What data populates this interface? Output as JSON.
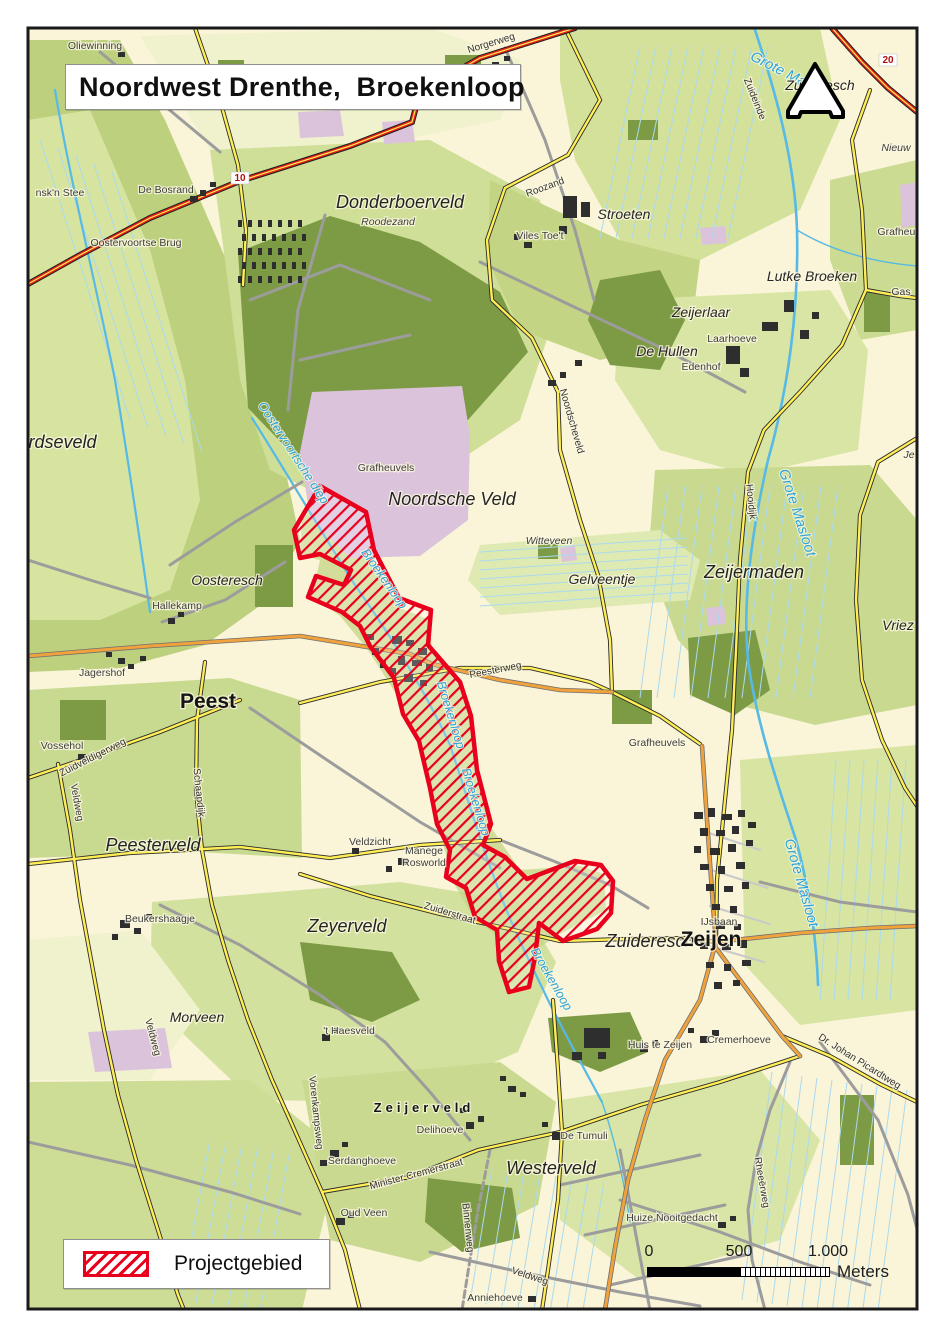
{
  "title": "Noordwest Drenthe,  Broekenloop",
  "legend": {
    "label": "Projectgebied",
    "swatch_icon": "red-hatch-swatch"
  },
  "scalebar": {
    "ticks": [
      "0",
      "500",
      "1.000"
    ],
    "units": "Meters"
  },
  "icons": {
    "north_arrow": "north-arrow"
  },
  "colors": {
    "project_red": "#e8001c",
    "water_blue": "#56b9e6",
    "forest_green": "#7d9b45",
    "field_green": "#cfdf97",
    "heath_pink": "#dcc3dc",
    "road_yellow": "#ffee55",
    "road_orange": "#f0a23c",
    "road_red": "#e32119",
    "paper_cream": "#faf4d8"
  },
  "map": {
    "labels": [
      {
        "t": "Oliewinning",
        "x": 95,
        "y": 49,
        "c": "farm"
      },
      {
        "t": "Norgerweg",
        "x": 492,
        "y": 46,
        "c": "road",
        "r": -17
      },
      {
        "t": "nsk'n Stee",
        "x": 60,
        "y": 196,
        "c": "farm"
      },
      {
        "t": "De Bosrand",
        "x": 166,
        "y": 193,
        "c": "farm"
      },
      {
        "t": "10",
        "x": 240,
        "y": 181,
        "c": "roadnum"
      },
      {
        "t": "20",
        "x": 888,
        "y": 63,
        "c": "roadnum"
      },
      {
        "t": "Oostervoortse Brug",
        "x": 136,
        "y": 246,
        "c": "farm"
      },
      {
        "t": "Donderboerveld",
        "x": 400,
        "y": 208,
        "c": "place-lg"
      },
      {
        "t": "Roodezand",
        "x": 388,
        "y": 225,
        "c": "farm-it"
      },
      {
        "t": "Roozand",
        "x": 546,
        "y": 190,
        "c": "road",
        "r": -20
      },
      {
        "t": "Stroeten",
        "x": 624,
        "y": 219,
        "c": "place-md"
      },
      {
        "t": "Viles Toe't",
        "x": 540,
        "y": 239,
        "c": "farm"
      },
      {
        "t": "Grote Masloot",
        "x": 790,
        "y": 80,
        "c": "water-lg",
        "r": 27
      },
      {
        "t": "Zuideresch",
        "x": 820,
        "y": 90,
        "c": "place-md"
      },
      {
        "t": "Zuideinde",
        "x": 752,
        "y": 100,
        "c": "road",
        "r": 68
      },
      {
        "t": "Nieuw",
        "x": 896,
        "y": 151,
        "c": "farm-it"
      },
      {
        "t": "Lutke Broeken",
        "x": 812,
        "y": 281,
        "c": "place-md"
      },
      {
        "t": "Grafheuv",
        "x": 899,
        "y": 235,
        "c": "farm"
      },
      {
        "t": "Gas",
        "x": 901,
        "y": 295,
        "c": "farm"
      },
      {
        "t": "Zeijerlaar",
        "x": 701,
        "y": 317,
        "c": "place-md"
      },
      {
        "t": "Laarhoeve",
        "x": 732,
        "y": 342,
        "c": "farm"
      },
      {
        "t": "De Hullen",
        "x": 667,
        "y": 356,
        "c": "place-md"
      },
      {
        "t": "Edenhof",
        "x": 701,
        "y": 370,
        "c": "farm"
      },
      {
        "t": "Noordscheveld",
        "x": 569,
        "y": 422,
        "c": "road",
        "r": 74
      },
      {
        "t": "Hooidijk",
        "x": 748,
        "y": 502,
        "c": "road",
        "r": 84
      },
      {
        "t": "Grote Masloot",
        "x": 793,
        "y": 514,
        "c": "water-lg",
        "r": 72
      },
      {
        "t": "Je",
        "x": 909,
        "y": 458,
        "c": "farm-it"
      },
      {
        "t": "Noordseveld",
        "x": 46,
        "y": 448,
        "c": "place-lg"
      },
      {
        "t": "Oostervoortsche diep",
        "x": 290,
        "y": 455,
        "c": "water",
        "r": 57
      },
      {
        "t": "Grafheuvels",
        "x": 386,
        "y": 471,
        "c": "farm"
      },
      {
        "t": "Noordsche Veld",
        "x": 452,
        "y": 505,
        "c": "place-lg"
      },
      {
        "t": "Witteveen",
        "x": 549,
        "y": 544,
        "c": "farm-it"
      },
      {
        "t": "Gelveentje",
        "x": 602,
        "y": 584,
        "c": "place-md"
      },
      {
        "t": "Zeijermaden",
        "x": 754,
        "y": 578,
        "c": "place-lg"
      },
      {
        "t": "Vriez",
        "x": 898,
        "y": 630,
        "c": "place-md"
      },
      {
        "t": "Oosteresch",
        "x": 227,
        "y": 585,
        "c": "place-md"
      },
      {
        "t": "Hallekamp",
        "x": 177,
        "y": 609,
        "c": "farm"
      },
      {
        "t": "Jagershof",
        "x": 102,
        "y": 676,
        "c": "farm"
      },
      {
        "t": "Peest",
        "x": 208,
        "y": 708,
        "c": "town"
      },
      {
        "t": "Vossehol",
        "x": 62,
        "y": 749,
        "c": "farm"
      },
      {
        "t": "Zuidveldigerweg",
        "x": 94,
        "y": 760,
        "c": "road",
        "r": -27
      },
      {
        "t": "Veldweg",
        "x": 74,
        "y": 803,
        "c": "road",
        "r": 80
      },
      {
        "t": "Schaapdijk",
        "x": 196,
        "y": 793,
        "c": "road",
        "r": 84
      },
      {
        "t": "Peesterveld",
        "x": 153,
        "y": 851,
        "c": "place-lg"
      },
      {
        "t": "Peesterweg",
        "x": 496,
        "y": 673,
        "c": "road",
        "r": -11
      },
      {
        "t": "Broekenloop",
        "x": 381,
        "y": 581,
        "c": "water",
        "r": 55
      },
      {
        "t": "Broekenloop",
        "x": 447,
        "y": 716,
        "c": "water",
        "r": 73
      },
      {
        "t": "Broekenloop",
        "x": 472,
        "y": 803,
        "c": "water",
        "r": 73
      },
      {
        "t": "Broekenloop",
        "x": 548,
        "y": 981,
        "c": "water",
        "r": 60
      },
      {
        "t": "Grafheuvels",
        "x": 657,
        "y": 746,
        "c": "farm"
      },
      {
        "t": "Veldzicht",
        "x": 370,
        "y": 845,
        "c": "farm"
      },
      {
        "t": "Manege",
        "x": 424,
        "y": 854,
        "c": "farm"
      },
      {
        "t": "Rosworld",
        "x": 424,
        "y": 866,
        "c": "farm"
      },
      {
        "t": "Zuiderstraat",
        "x": 449,
        "y": 916,
        "c": "road",
        "r": 17
      },
      {
        "t": "Zuideresch",
        "x": 650,
        "y": 947,
        "c": "place-lg"
      },
      {
        "t": "Zeijen",
        "x": 711,
        "y": 946,
        "c": "town"
      },
      {
        "t": "IJsbaan",
        "x": 719,
        "y": 925,
        "c": "farm"
      },
      {
        "t": "Grote Masloot",
        "x": 797,
        "y": 884,
        "c": "water-lg",
        "r": 74
      },
      {
        "t": "Morveen",
        "x": 197,
        "y": 1022,
        "c": "place-md"
      },
      {
        "t": "Beukershaagje",
        "x": 160,
        "y": 922,
        "c": "farm"
      },
      {
        "t": "Zeyerveld",
        "x": 347,
        "y": 932,
        "c": "place-lg"
      },
      {
        "t": "'t Haesveld",
        "x": 349,
        "y": 1034,
        "c": "farm"
      },
      {
        "t": "Veldweg",
        "x": 150,
        "y": 1038,
        "c": "road",
        "r": 75
      },
      {
        "t": "Huis te Zeijen",
        "x": 660,
        "y": 1048,
        "c": "farm"
      },
      {
        "t": "Cremerhoeve",
        "x": 739,
        "y": 1043,
        "c": "farm"
      },
      {
        "t": "Dr. Johan Picardtweg",
        "x": 858,
        "y": 1064,
        "c": "road",
        "r": 32
      },
      {
        "t": "Rheeërweg",
        "x": 759,
        "y": 1183,
        "c": "road",
        "r": 80
      },
      {
        "t": "Huize Nooitgedacht",
        "x": 672,
        "y": 1221,
        "c": "farm"
      },
      {
        "t": "Zeijerveld",
        "x": 424,
        "y": 1112,
        "c": "town-sp"
      },
      {
        "t": "Delihoeve",
        "x": 440,
        "y": 1133,
        "c": "farm"
      },
      {
        "t": "Serdanghoeve",
        "x": 362,
        "y": 1164,
        "c": "farm"
      },
      {
        "t": "Oud Veen",
        "x": 364,
        "y": 1216,
        "c": "farm"
      },
      {
        "t": "Minister Cremerstraat",
        "x": 417,
        "y": 1177,
        "c": "road",
        "r": -15
      },
      {
        "t": "Vorenkampsweg",
        "x": 313,
        "y": 1113,
        "c": "road",
        "r": 84
      },
      {
        "t": "De Tumuli",
        "x": 584,
        "y": 1139,
        "c": "farm"
      },
      {
        "t": "Westerveld",
        "x": 551,
        "y": 1174,
        "c": "place-lg"
      },
      {
        "t": "Binnenweg",
        "x": 465,
        "y": 1228,
        "c": "road",
        "r": 84
      },
      {
        "t": "Veldweg",
        "x": 529,
        "y": 1279,
        "c": "road",
        "r": 18
      },
      {
        "t": "Anniehoeve",
        "x": 495,
        "y": 1301,
        "c": "farm"
      }
    ]
  }
}
